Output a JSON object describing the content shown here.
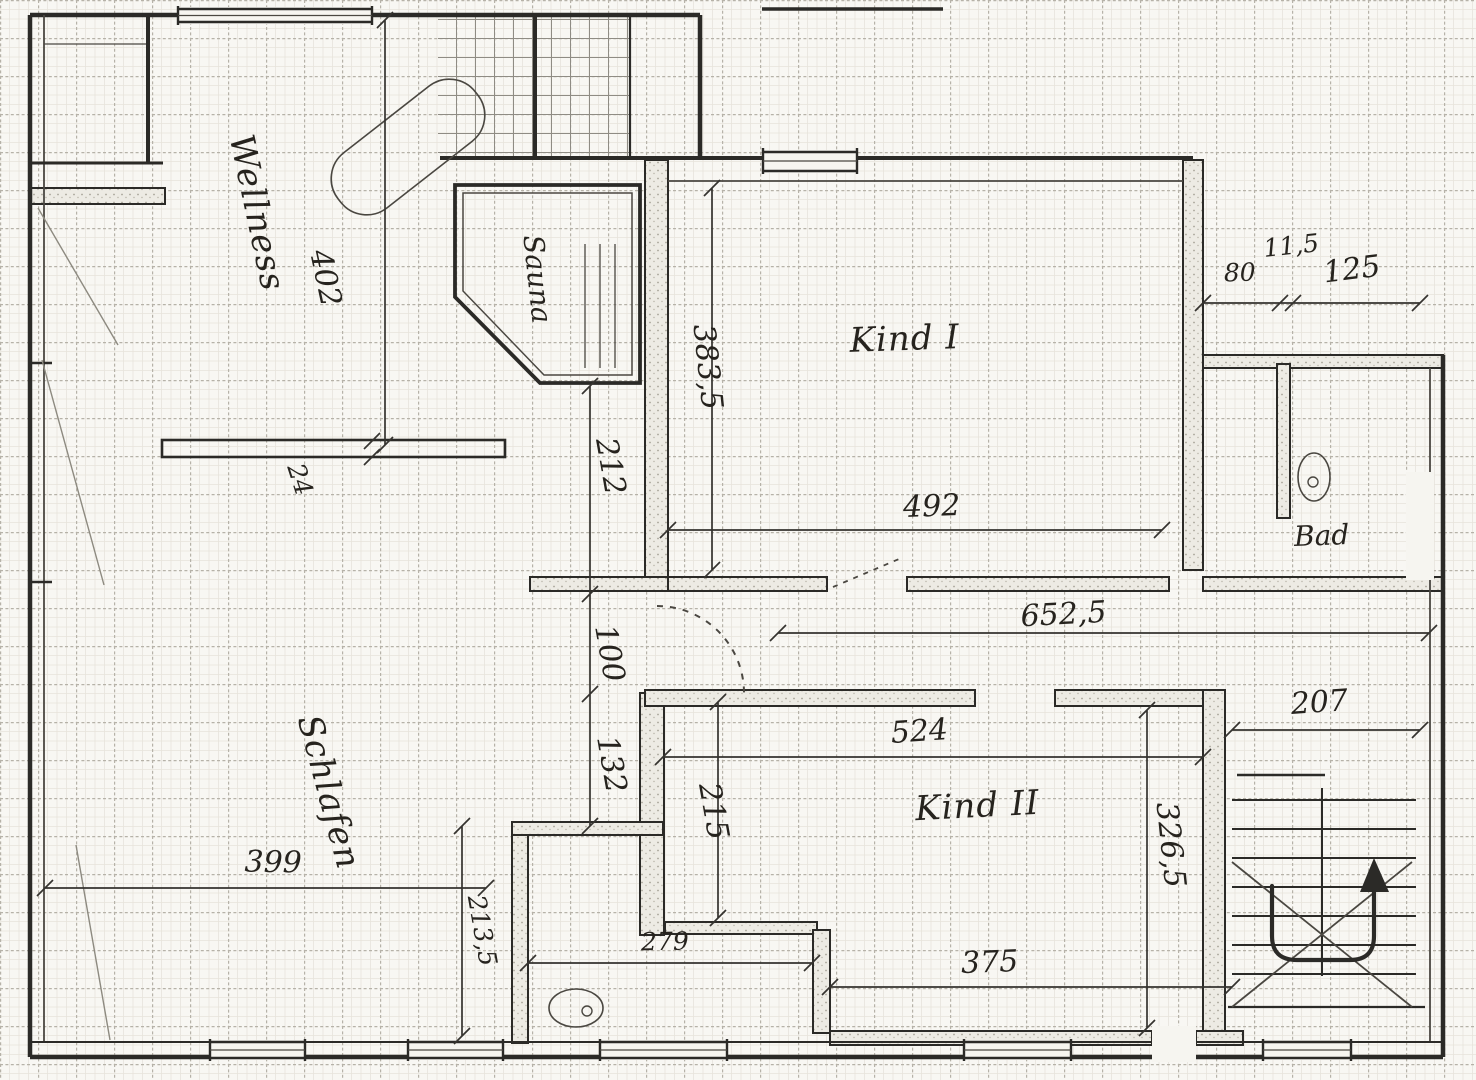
{
  "rooms": {
    "wellness": "Wellness",
    "sauna": "Sauna",
    "schlafen": "Schlafen",
    "kind_1": "Kind I",
    "kind_2": "Kind II",
    "bad": "Bad"
  },
  "dims": {
    "wellness_length": "402",
    "shelf_thickness": "24",
    "kind1_side": "383,5",
    "sauna_to_door": "212",
    "door_opening": "100",
    "door_to_wall": "132",
    "alcove_depth": "215",
    "kind1_width": "492",
    "corridor_length": "652,5",
    "bad_shower_width": "80",
    "bad_partition": "11,5",
    "bad_inner_width": "125",
    "kind2_width": "524",
    "stairs_width": "207",
    "kind2_depth": "326,5",
    "kind2_bottom_width": "375",
    "bath_width": "279",
    "schlafen_width": "399",
    "bath_side_depth": "213,5"
  }
}
